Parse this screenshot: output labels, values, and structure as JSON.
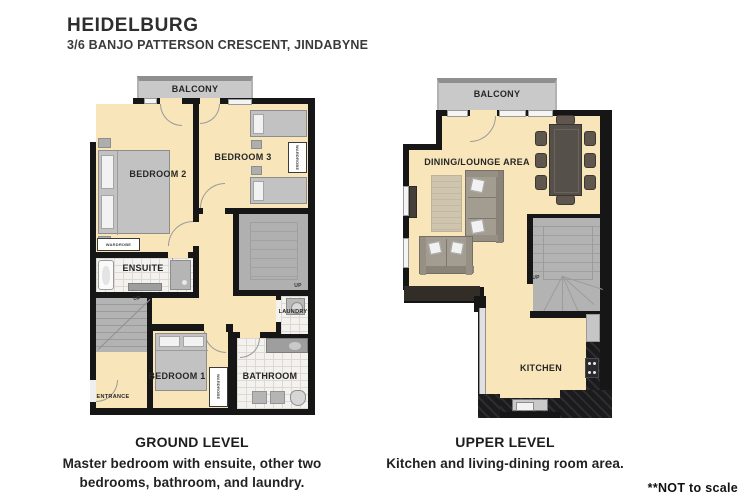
{
  "header": {
    "title": "HEIDELBURG",
    "address": "3/6 BANJO PATTERSON CRESCENT, JINDABYNE"
  },
  "shared": {
    "balcony": "BALCONY",
    "wardrobe": "WARDROBE",
    "up": "UP"
  },
  "ground": {
    "bedroom2": "BEDROOM 2",
    "bedroom3": "BEDROOM 3",
    "ensuite": "ENSUITE",
    "bedroom1": "BEDROOM 1",
    "bathroom": "BATHROOM",
    "laundry": "LAUNDRY",
    "entrance": "ENTRANCE",
    "caption_title": "GROUND LEVEL",
    "caption_line1": "Master bedroom with ensuite, other two",
    "caption_line2": "bedrooms, bathroom, and laundry."
  },
  "upper": {
    "dining": "DINING/LOUNGE AREA",
    "kitchen": "KITCHEN",
    "caption_title": "UPPER LEVEL",
    "caption_line1": "Kitchen and living-dining room area."
  },
  "note": "**NOT to scale",
  "colors": {
    "floor": "#f8e6ba",
    "wall": "#161616",
    "balcony": "#c9c9c9",
    "stairs": "#b3b3b3",
    "counter_dark": "#1b1b1d",
    "table": "#56504a"
  }
}
